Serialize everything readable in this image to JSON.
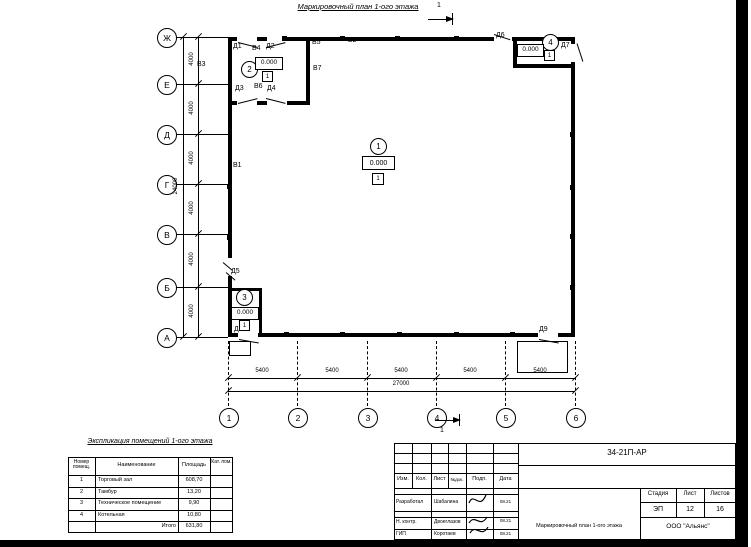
{
  "plan": {
    "title": "Маркировочный план 1-ого этажа",
    "section_mark": "1",
    "marks": {
      "d1": "Д1",
      "d2": "Д2",
      "d3": "Д3",
      "d4": "Д4",
      "d5": "Д5",
      "d6": "Д6",
      "d7": "Д7",
      "d8": "Д8",
      "d9": "Д9",
      "v1": "В1",
      "v2": "В2",
      "v3": "В3",
      "v4": "В4",
      "v5": "В5",
      "v6": "В6",
      "v7": "В7"
    },
    "rooms": [
      {
        "num": "1",
        "elev": "0.000",
        "floor": "1"
      },
      {
        "num": "2",
        "elev": "0.000",
        "floor": "1"
      },
      {
        "num": "3",
        "elev": "0.000",
        "floor": "1"
      },
      {
        "num": "4",
        "elev": "0.000",
        "floor": "1"
      }
    ]
  },
  "axes": {
    "letters": [
      "Ж",
      "Е",
      "Д",
      "Г",
      "В",
      "Б",
      "А"
    ],
    "numbers": [
      "1",
      "2",
      "3",
      "4",
      "5",
      "6"
    ],
    "dims_v": [
      "4000",
      "4000",
      "4000",
      "4000",
      "4000",
      "4000"
    ],
    "dim_v_total": "24000",
    "dims_h": [
      "5400",
      "5400",
      "5400",
      "5400",
      "5400"
    ],
    "dim_h_total": "27000"
  },
  "explication": {
    "title": "Экспликация помещений 1-ого этажа",
    "headers": {
      "num": "Номер помещ.",
      "name": "Наименование",
      "area": "Площадь",
      "cat": "Кат. пом."
    },
    "rows": [
      {
        "num": "1",
        "name": "Торговый зал",
        "area": "608,70"
      },
      {
        "num": "2",
        "name": "Тамбур",
        "area": "13,20"
      },
      {
        "num": "3",
        "name": "Техническое помещение",
        "area": "9,90"
      },
      {
        "num": "4",
        "name": "Котельная",
        "area": "10,80"
      }
    ],
    "total_label": "Итого",
    "total": "631,80"
  },
  "titleblock": {
    "code": "34-21П-АР",
    "cols": [
      "Изм.",
      "Кол.",
      "Лист",
      "№док.",
      "Подп.",
      "Дата"
    ],
    "rows": [
      {
        "role": "Разработал",
        "name": "Шабалина",
        "date": "08.21"
      },
      {
        "role": "Н. контр.",
        "name": "Двоеглазов",
        "date": "08.21"
      },
      {
        "role": "ГИП",
        "name": "Коротаев",
        "date": "08.21"
      }
    ],
    "stage_label": "Стадия",
    "list_label": "Лист",
    "lists_label": "Листов",
    "stage": "ЭП",
    "list_no": "12",
    "lists_total": "16",
    "doc_title": "Маркировочный план 1-ого этажа",
    "company": "ООО \"Альянс\""
  },
  "colors": {
    "ink": "#000000",
    "paper": "#ffffff"
  }
}
